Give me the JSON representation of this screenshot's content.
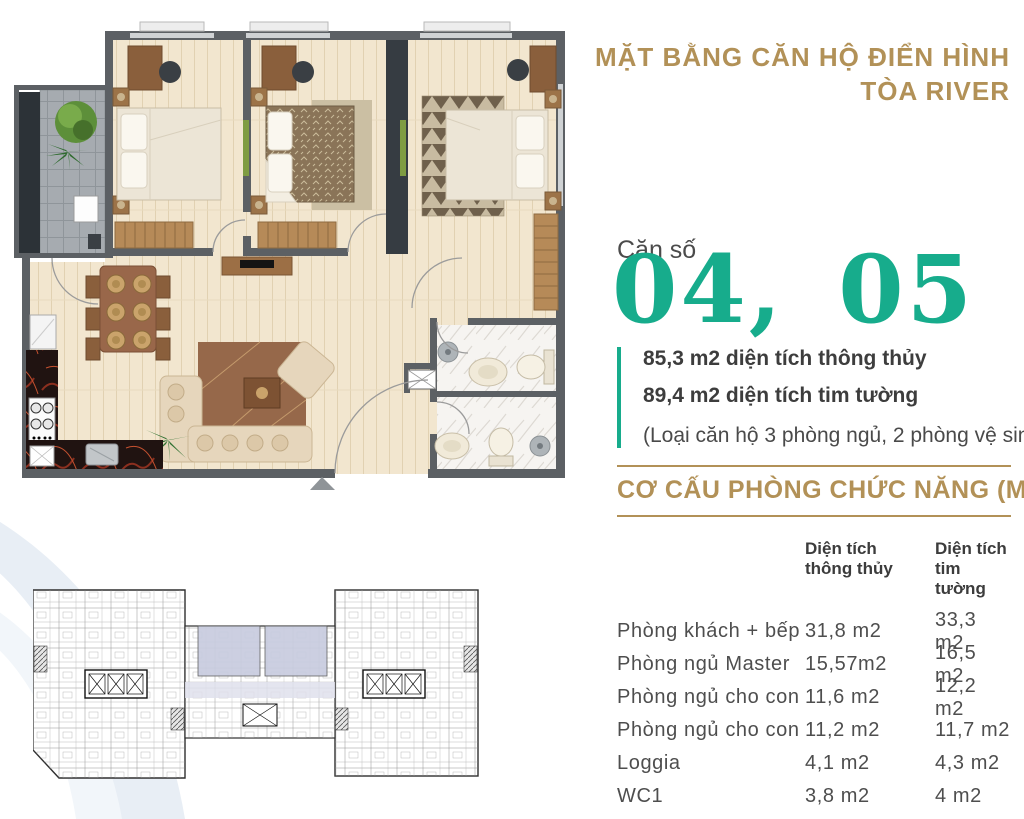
{
  "header": {
    "title_line1": "MẶT BẰNG CĂN HỘ ĐIỂN HÌNH",
    "title_line2": "TÒA RIVER"
  },
  "unit": {
    "label": "Căn số",
    "numbers": "04, 05",
    "area_thong_thuy": "85,3 m2 diện tích thông thủy",
    "area_tim_tuong": "89,4 m2 diện tích tim tường",
    "note": "(Loại căn hộ 3 phòng ngủ, 2 phòng vệ sinh)"
  },
  "room_table": {
    "title": "CƠ CẤU PHÒNG CHỨC NĂNG (M2)",
    "col_thong_thuy_line1": "Diện tích",
    "col_thong_thuy_line2": "thông thủy",
    "col_tim_tuong_line1": "Diện tích",
    "col_tim_tuong_line2": "tim tường",
    "rows": [
      {
        "name": "Phòng khách + bếp",
        "thong_thuy": "31,8 m2",
        "tim_tuong": "33,3 m2"
      },
      {
        "name": "Phòng ngủ Master",
        "thong_thuy": "15,57m2",
        "tim_tuong": "16,5 m2"
      },
      {
        "name": "Phòng ngủ cho con",
        "thong_thuy": "11,6 m2",
        "tim_tuong": "12,2 m2"
      },
      {
        "name": "Phòng ngủ cho con",
        "thong_thuy": "11,2 m2",
        "tim_tuong": "11,7 m2"
      },
      {
        "name": "Loggia",
        "thong_thuy": "4,1 m2",
        "tim_tuong": "4,3 m2"
      },
      {
        "name": "WC1",
        "thong_thuy": "3,8 m2",
        "tim_tuong": "4 m2"
      },
      {
        "name": "WC2",
        "thong_thuy": "4,2 m2",
        "tim_tuong": "4,4 m2"
      }
    ]
  },
  "colors": {
    "gold": "#b29157",
    "teal": "#17ac8c",
    "wall_gray": "#5c6064",
    "unit_highlight": "#c8ccdf"
  }
}
